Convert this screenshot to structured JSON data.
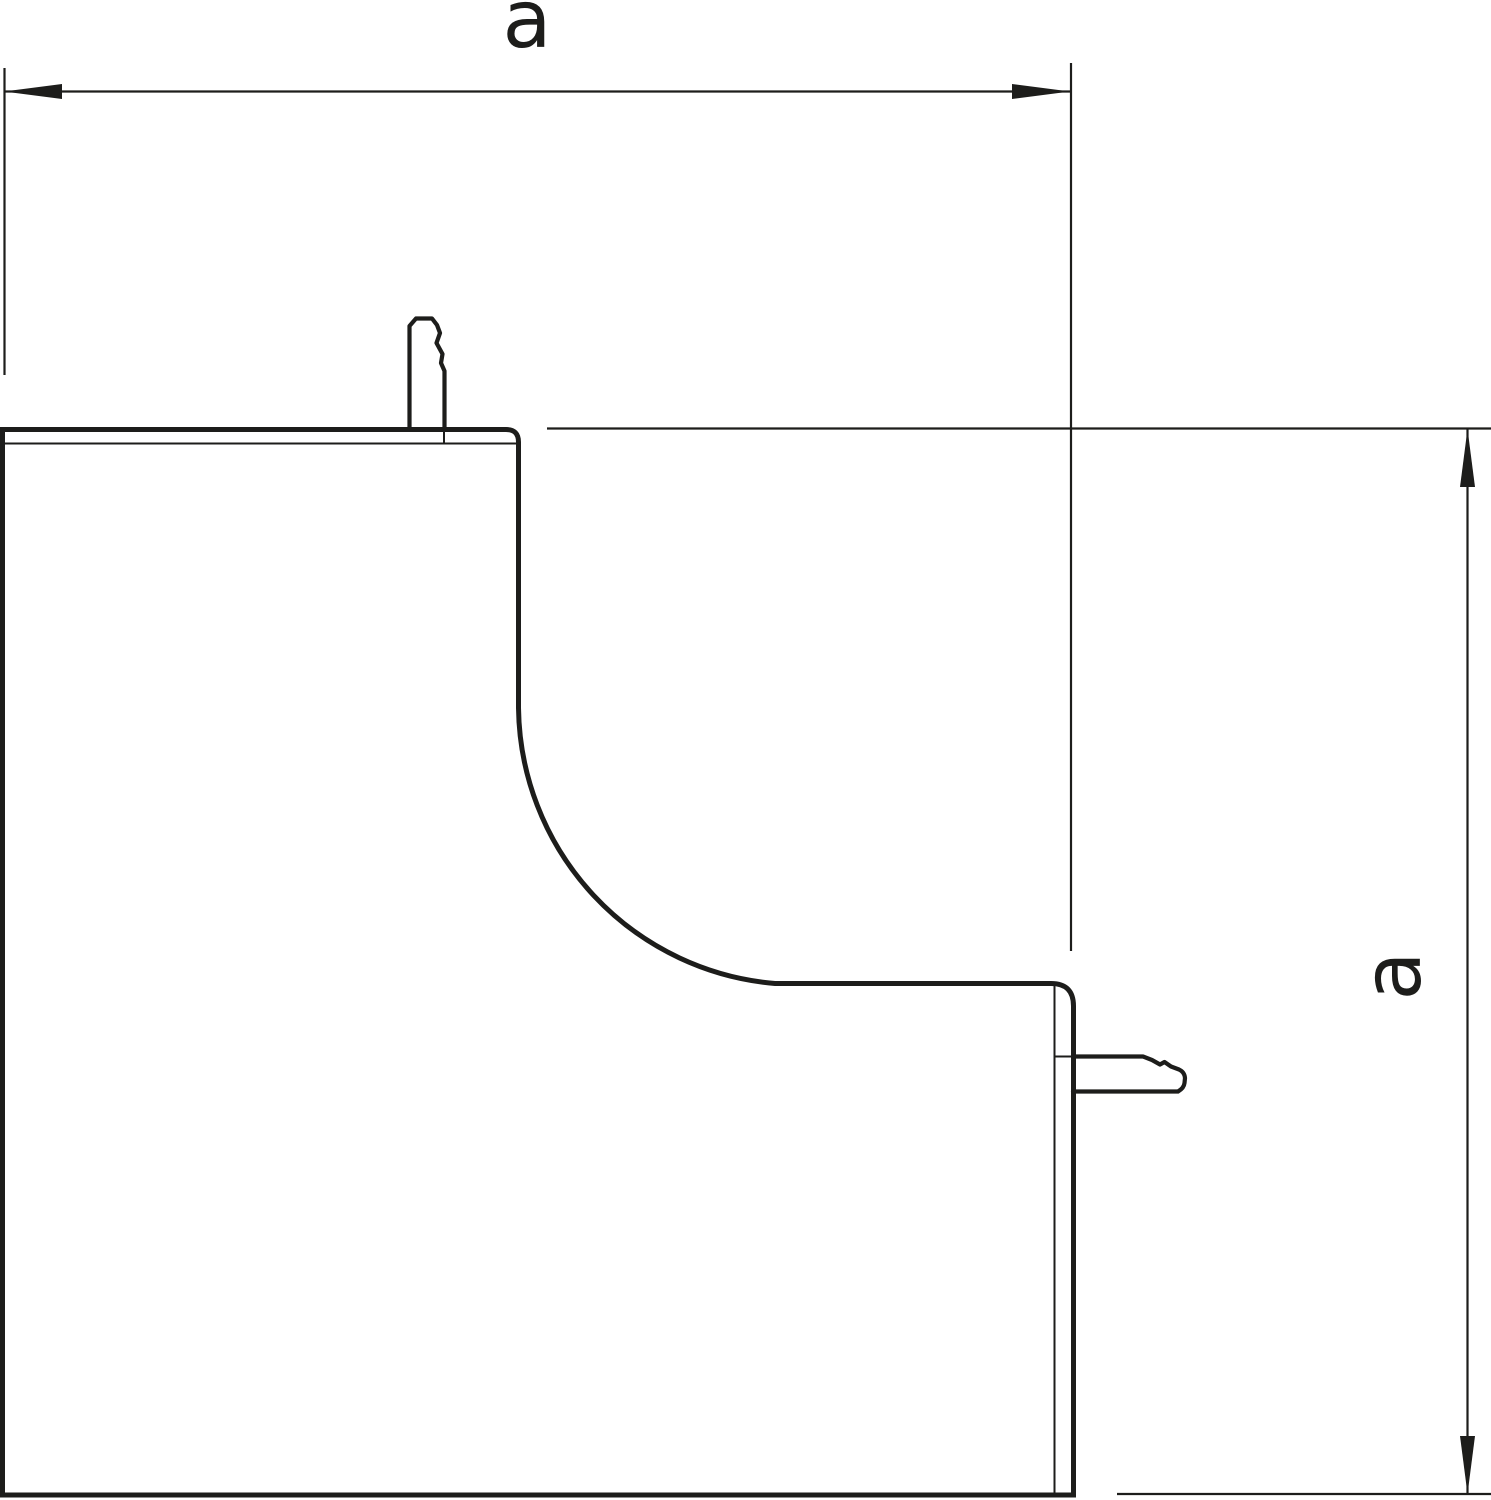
{
  "drawing": {
    "kind": "technical dimension drawing",
    "dimension_horizontal": {
      "label": "a"
    },
    "dimension_vertical": {
      "label": "a"
    }
  },
  "colors": {
    "line": "#1d1d1b",
    "background": "#ffffff"
  }
}
